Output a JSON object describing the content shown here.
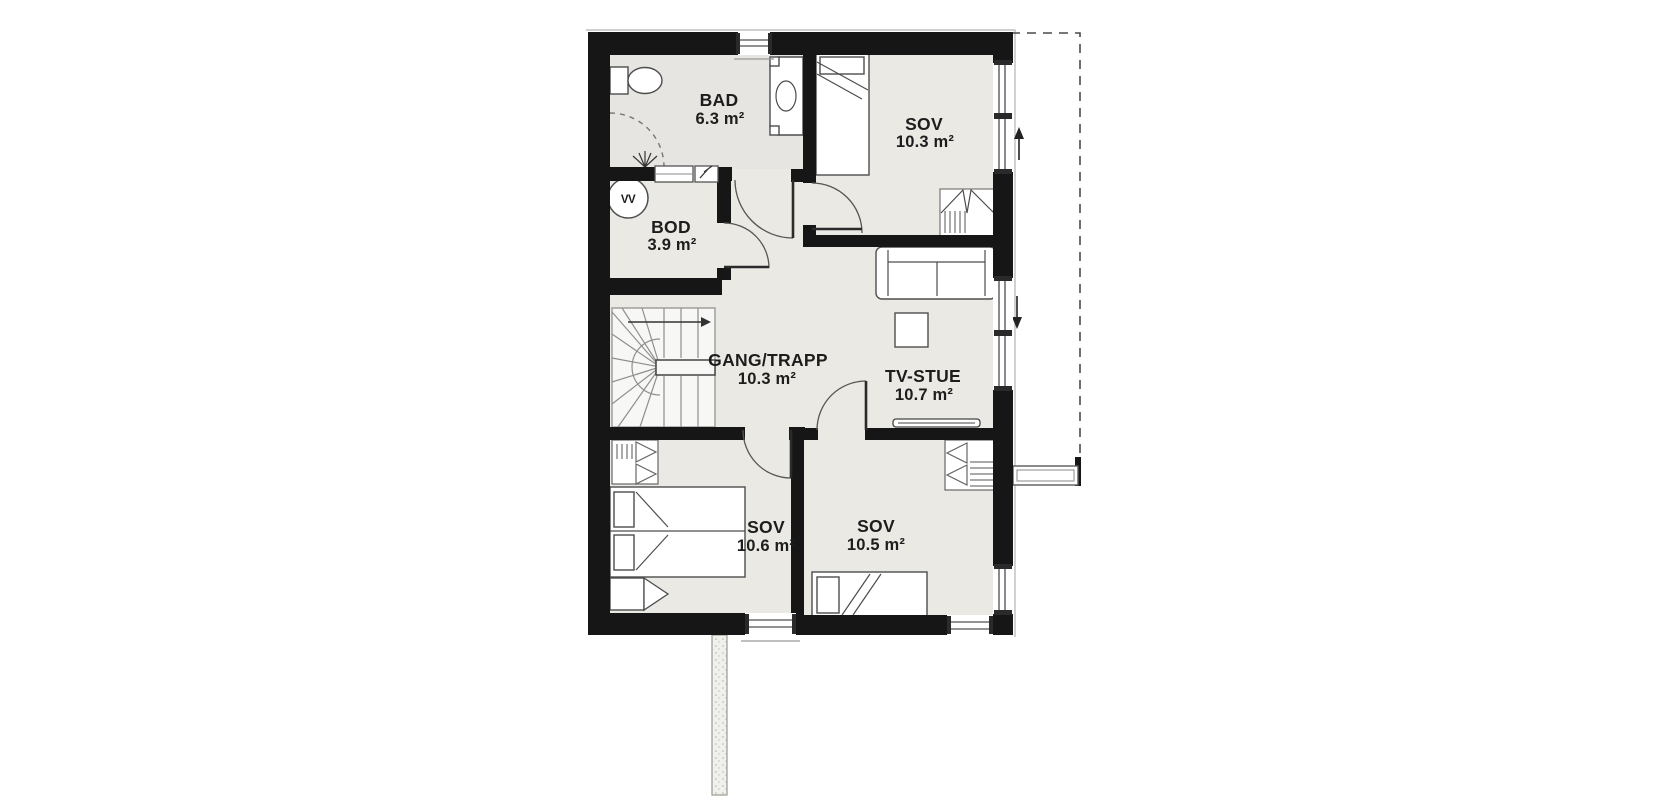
{
  "title": "Floor plan",
  "rooms": {
    "bad": {
      "name": "BAD",
      "area": "6.3 m²"
    },
    "sov1": {
      "name": "SOV",
      "area": "10.3 m²"
    },
    "bod": {
      "name": "BOD",
      "area": "3.9 m²"
    },
    "gang": {
      "name": "GANG/TRAPP",
      "area": "10.3 m²"
    },
    "tvstue": {
      "name": "TV-STUE",
      "area": "10.7 m²"
    },
    "sov2": {
      "name": "SOV",
      "area": "10.6 m²"
    },
    "sov3": {
      "name": "SOV",
      "area": "10.5 m²"
    }
  },
  "icons": {
    "water_heater_label": "VV"
  },
  "colors": {
    "wall": "#161616",
    "floor": "#ebe9e4",
    "floor_bath": "#e6e5e1",
    "floor_stairs": "#f7f7f5",
    "background": "#ffffff"
  }
}
